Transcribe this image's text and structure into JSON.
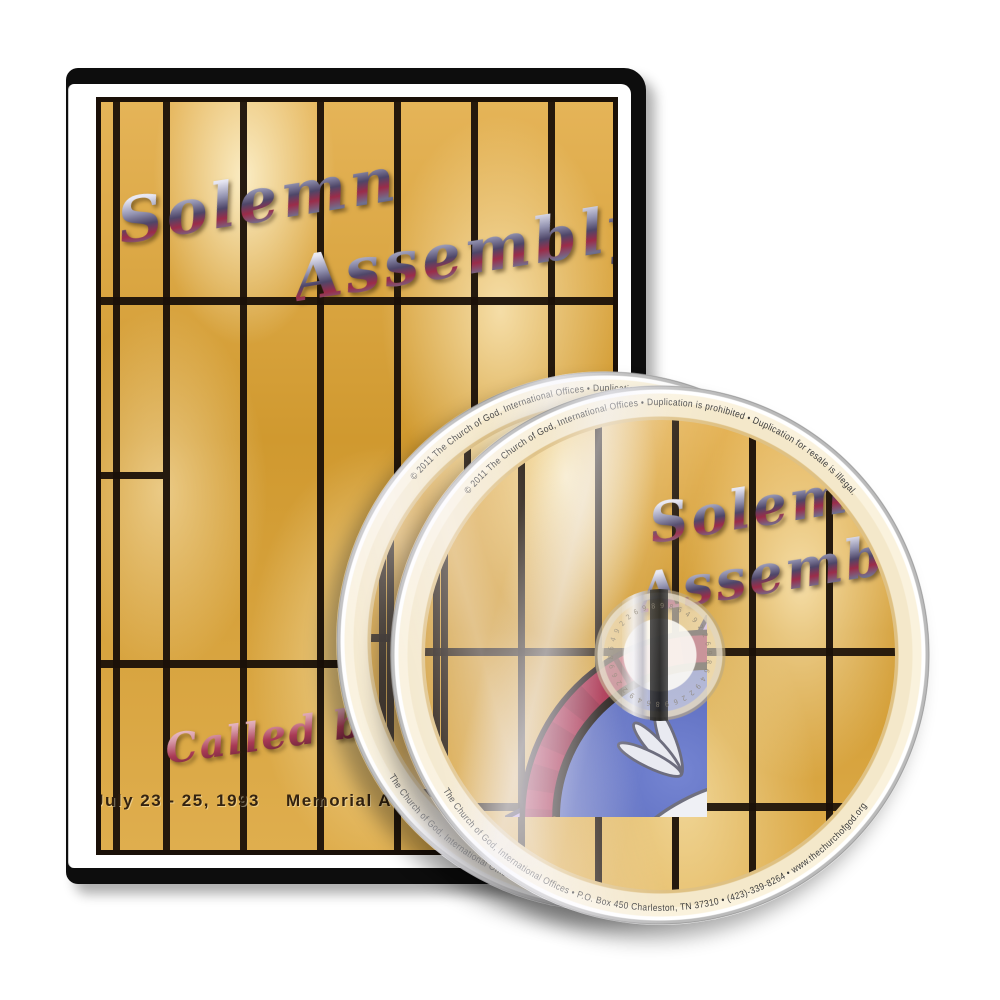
{
  "photo": {
    "background_color": "#ffffff"
  },
  "case": {
    "title_line1": "Solemn",
    "title_line2": "Assembly",
    "script_caption": "Called by t",
    "footer_date": "July 23 - 25, 1993",
    "footer_venue": "Memorial Au",
    "colors": {
      "case_black": "#0d0d0d",
      "glass_amber": "#d9a440",
      "lead_black": "#1a1008"
    }
  },
  "disc": {
    "title_line1": "Solemn",
    "title_line2": "Assembly",
    "top_arc_text": "© 2011 The Church of God, International Offices • Duplication is prohibited • Duplication for resale is illegal.",
    "bottom_arc_text": "The Church of God, International Offices • P.O. Box 450 Charleston, TN 37310 • (423)-339-8264 • www.thechurchofgod.org",
    "hub_etching": "9864922698649226986492269864922698",
    "colors": {
      "label_cream": "#f3e6c3",
      "arc_text": "#3b3b3b"
    }
  },
  "medallion_colors": {
    "ring_red": "#a52544",
    "field_blue": "#5363b8",
    "accent_purple": "#b590d8",
    "dove_white": "#eff0f5",
    "leaf_green": "#3f6d26"
  }
}
